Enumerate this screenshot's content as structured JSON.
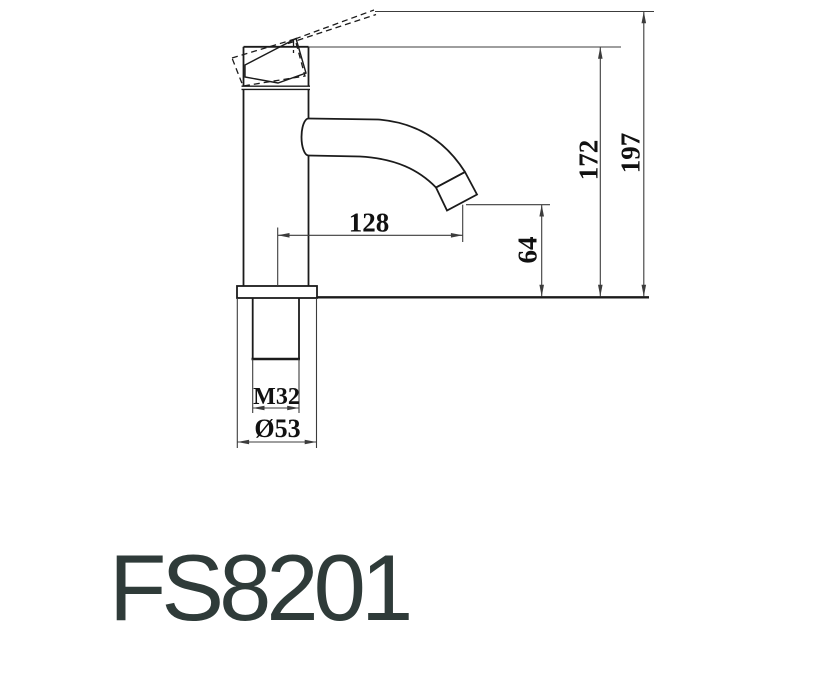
{
  "product": {
    "code": "FS8201"
  },
  "dimensions": {
    "overall_height": "197",
    "spout_top_height": "172",
    "outlet_height": "64",
    "spout_reach": "128",
    "thread_spec": "M32",
    "base_diameter": "Ø53"
  },
  "colors": {
    "background": "#ffffff",
    "object_line": "#1b1b1b",
    "dimension_line": "#3c3c3c",
    "dimension_text": "#111111",
    "product_code_text": "#2f3b39"
  }
}
